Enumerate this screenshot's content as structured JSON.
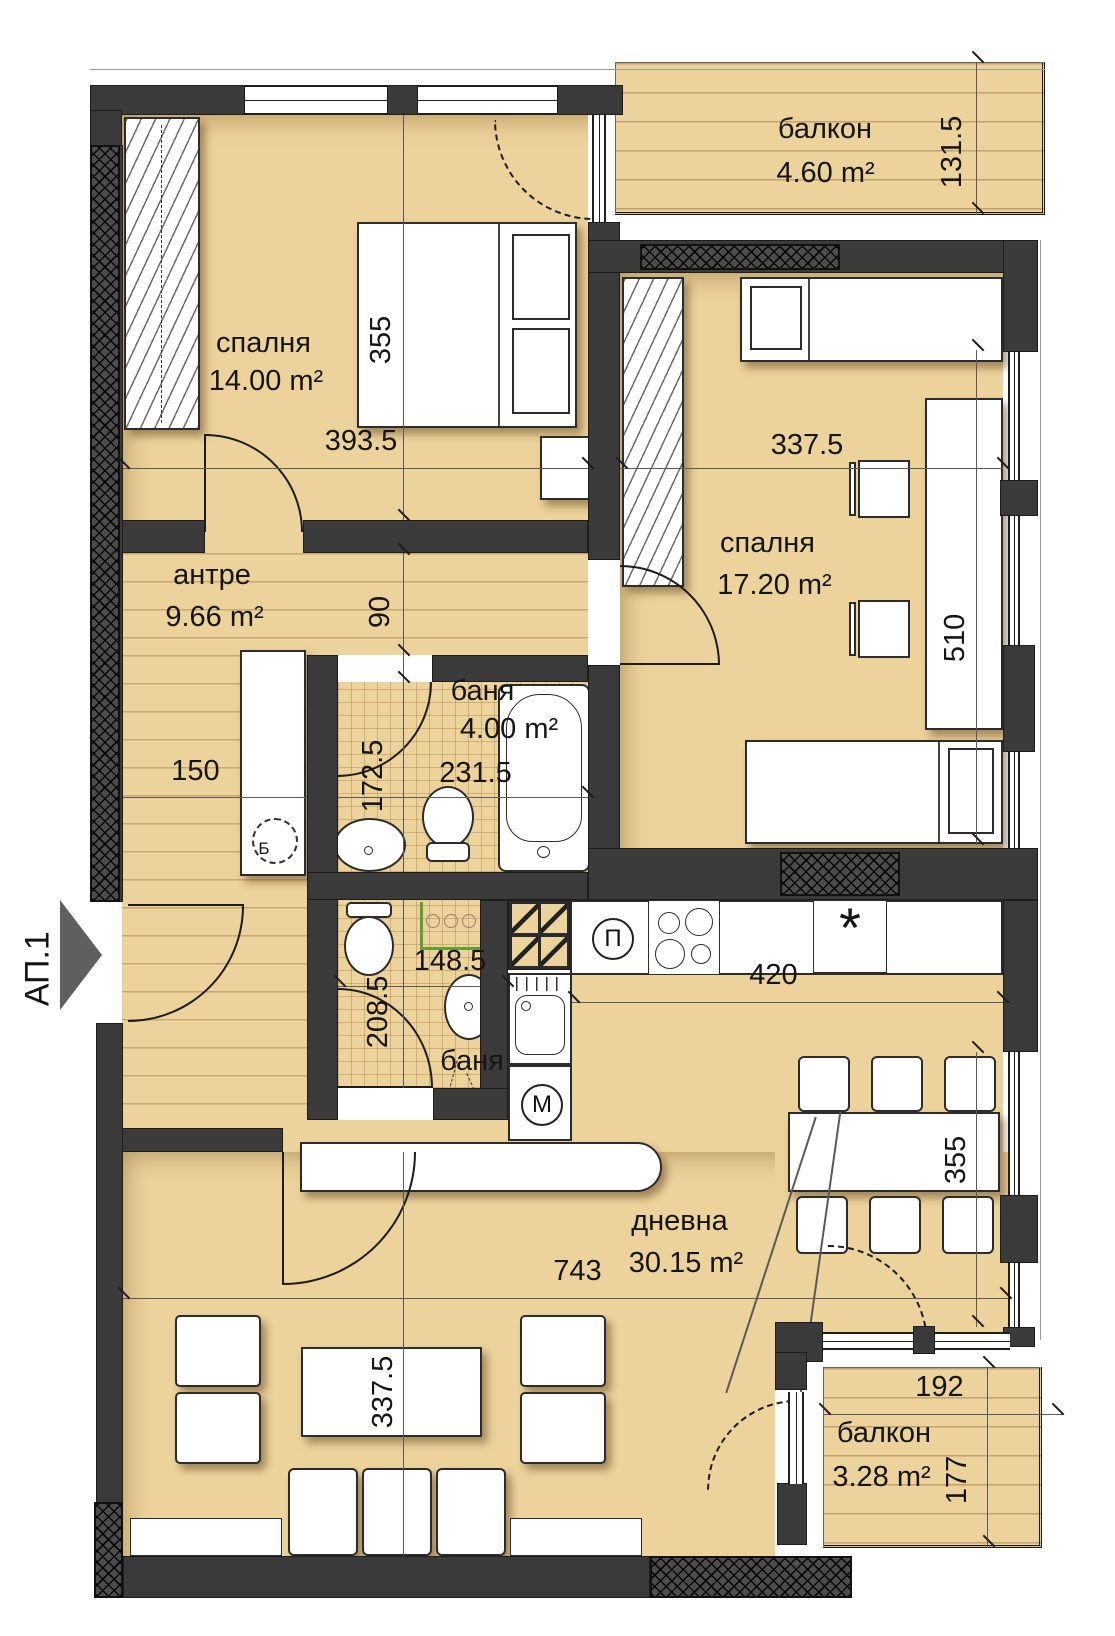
{
  "entrance": {
    "label": "АП.1"
  },
  "rooms": {
    "bedroom1": {
      "name": "спалня",
      "area": "14.00 m²"
    },
    "bedroom2": {
      "name": "спалня",
      "area": "17.20 m²"
    },
    "hall": {
      "name": "антре",
      "area": "9.66 m²"
    },
    "bath1": {
      "name": "баня",
      "area": "4.00 m²"
    },
    "bath2": {
      "name": "баня"
    },
    "living": {
      "name": "дневна",
      "area": "30.15 m²"
    },
    "balcony_top": {
      "name": "балкон",
      "area": "4.60 m²"
    },
    "balcony_bottom": {
      "name": "балкон",
      "area": "3.28 m²"
    }
  },
  "dimensions": {
    "bedroom1_bed": "355",
    "bedroom1_width": "393.5",
    "balcony_top_depth": "131.5",
    "bedroom2_width": "337.5",
    "bedroom2_depth": "510",
    "corridor": "90",
    "hall_width": "150",
    "bath1_width": "231.5",
    "bath1_depth": "172.5",
    "bath2_width": "148.5",
    "bath2_depth": "208.5",
    "kitchen_width": "420",
    "living_width": "743",
    "living_table": "337.5",
    "dining": "355",
    "balcony_bottom_width": "192",
    "balcony_bottom_depth": "177"
  },
  "appliances": {
    "fridge_label": "П",
    "washer_label": "М",
    "boiler_label": "Б",
    "appliance_symbol": "*"
  }
}
